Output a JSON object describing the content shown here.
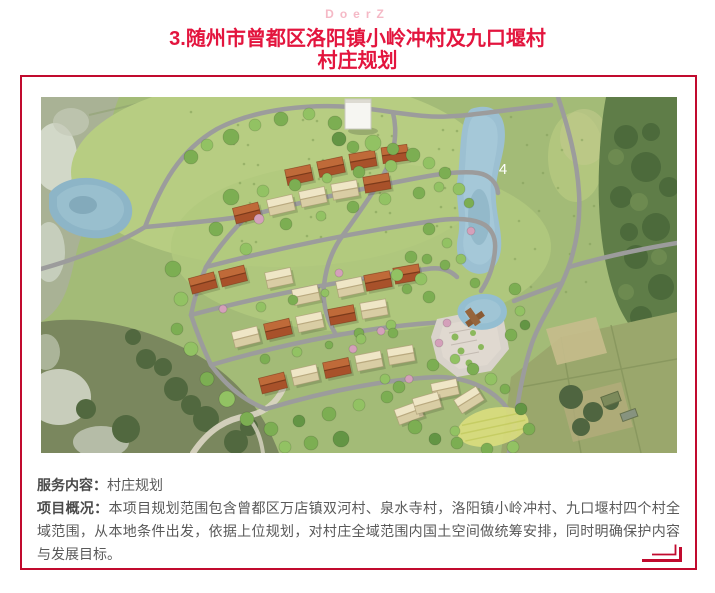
{
  "header": {
    "watermark": "DoerZ",
    "title_line1": "3.随州市曾都区洛阳镇小岭冲村及九口堰村",
    "title_line2": "村庄规划"
  },
  "description": {
    "rows": [
      {
        "label": "服务内容：",
        "text": "村庄规划"
      },
      {
        "label": "项目概况：",
        "text": "本项目规划范围包含曾都区万店镇双河村、泉水寺村，洛阳镇小岭冲村、九口堰村四个村全域范围，从本地条件出发，依据上位规划，对村庄全域范围内国土空间做统筹安排，同时明确保护内容与发展目标。"
      }
    ]
  },
  "map": {
    "pond_label": "4",
    "marker_color": "#d93025",
    "markers": [
      {
        "n": "1",
        "x": 438,
        "y": 256
      },
      {
        "n": "2",
        "x": 433,
        "y": 219
      },
      {
        "n": "3",
        "x": 411,
        "y": 210
      },
      {
        "n": "4",
        "x": 456,
        "y": 209
      },
      {
        "n": "5",
        "x": 405,
        "y": 189
      },
      {
        "n": "6",
        "x": 296,
        "y": 196
      },
      {
        "n": "7",
        "x": 404,
        "y": 318
      },
      {
        "n": "8",
        "x": 430,
        "y": 329
      }
    ]
  },
  "colors": {
    "title": "#e3153e",
    "watermark": "#f5b9c6",
    "border": "#c10a2e",
    "body_text": "#595959",
    "marker": "#d93025"
  }
}
